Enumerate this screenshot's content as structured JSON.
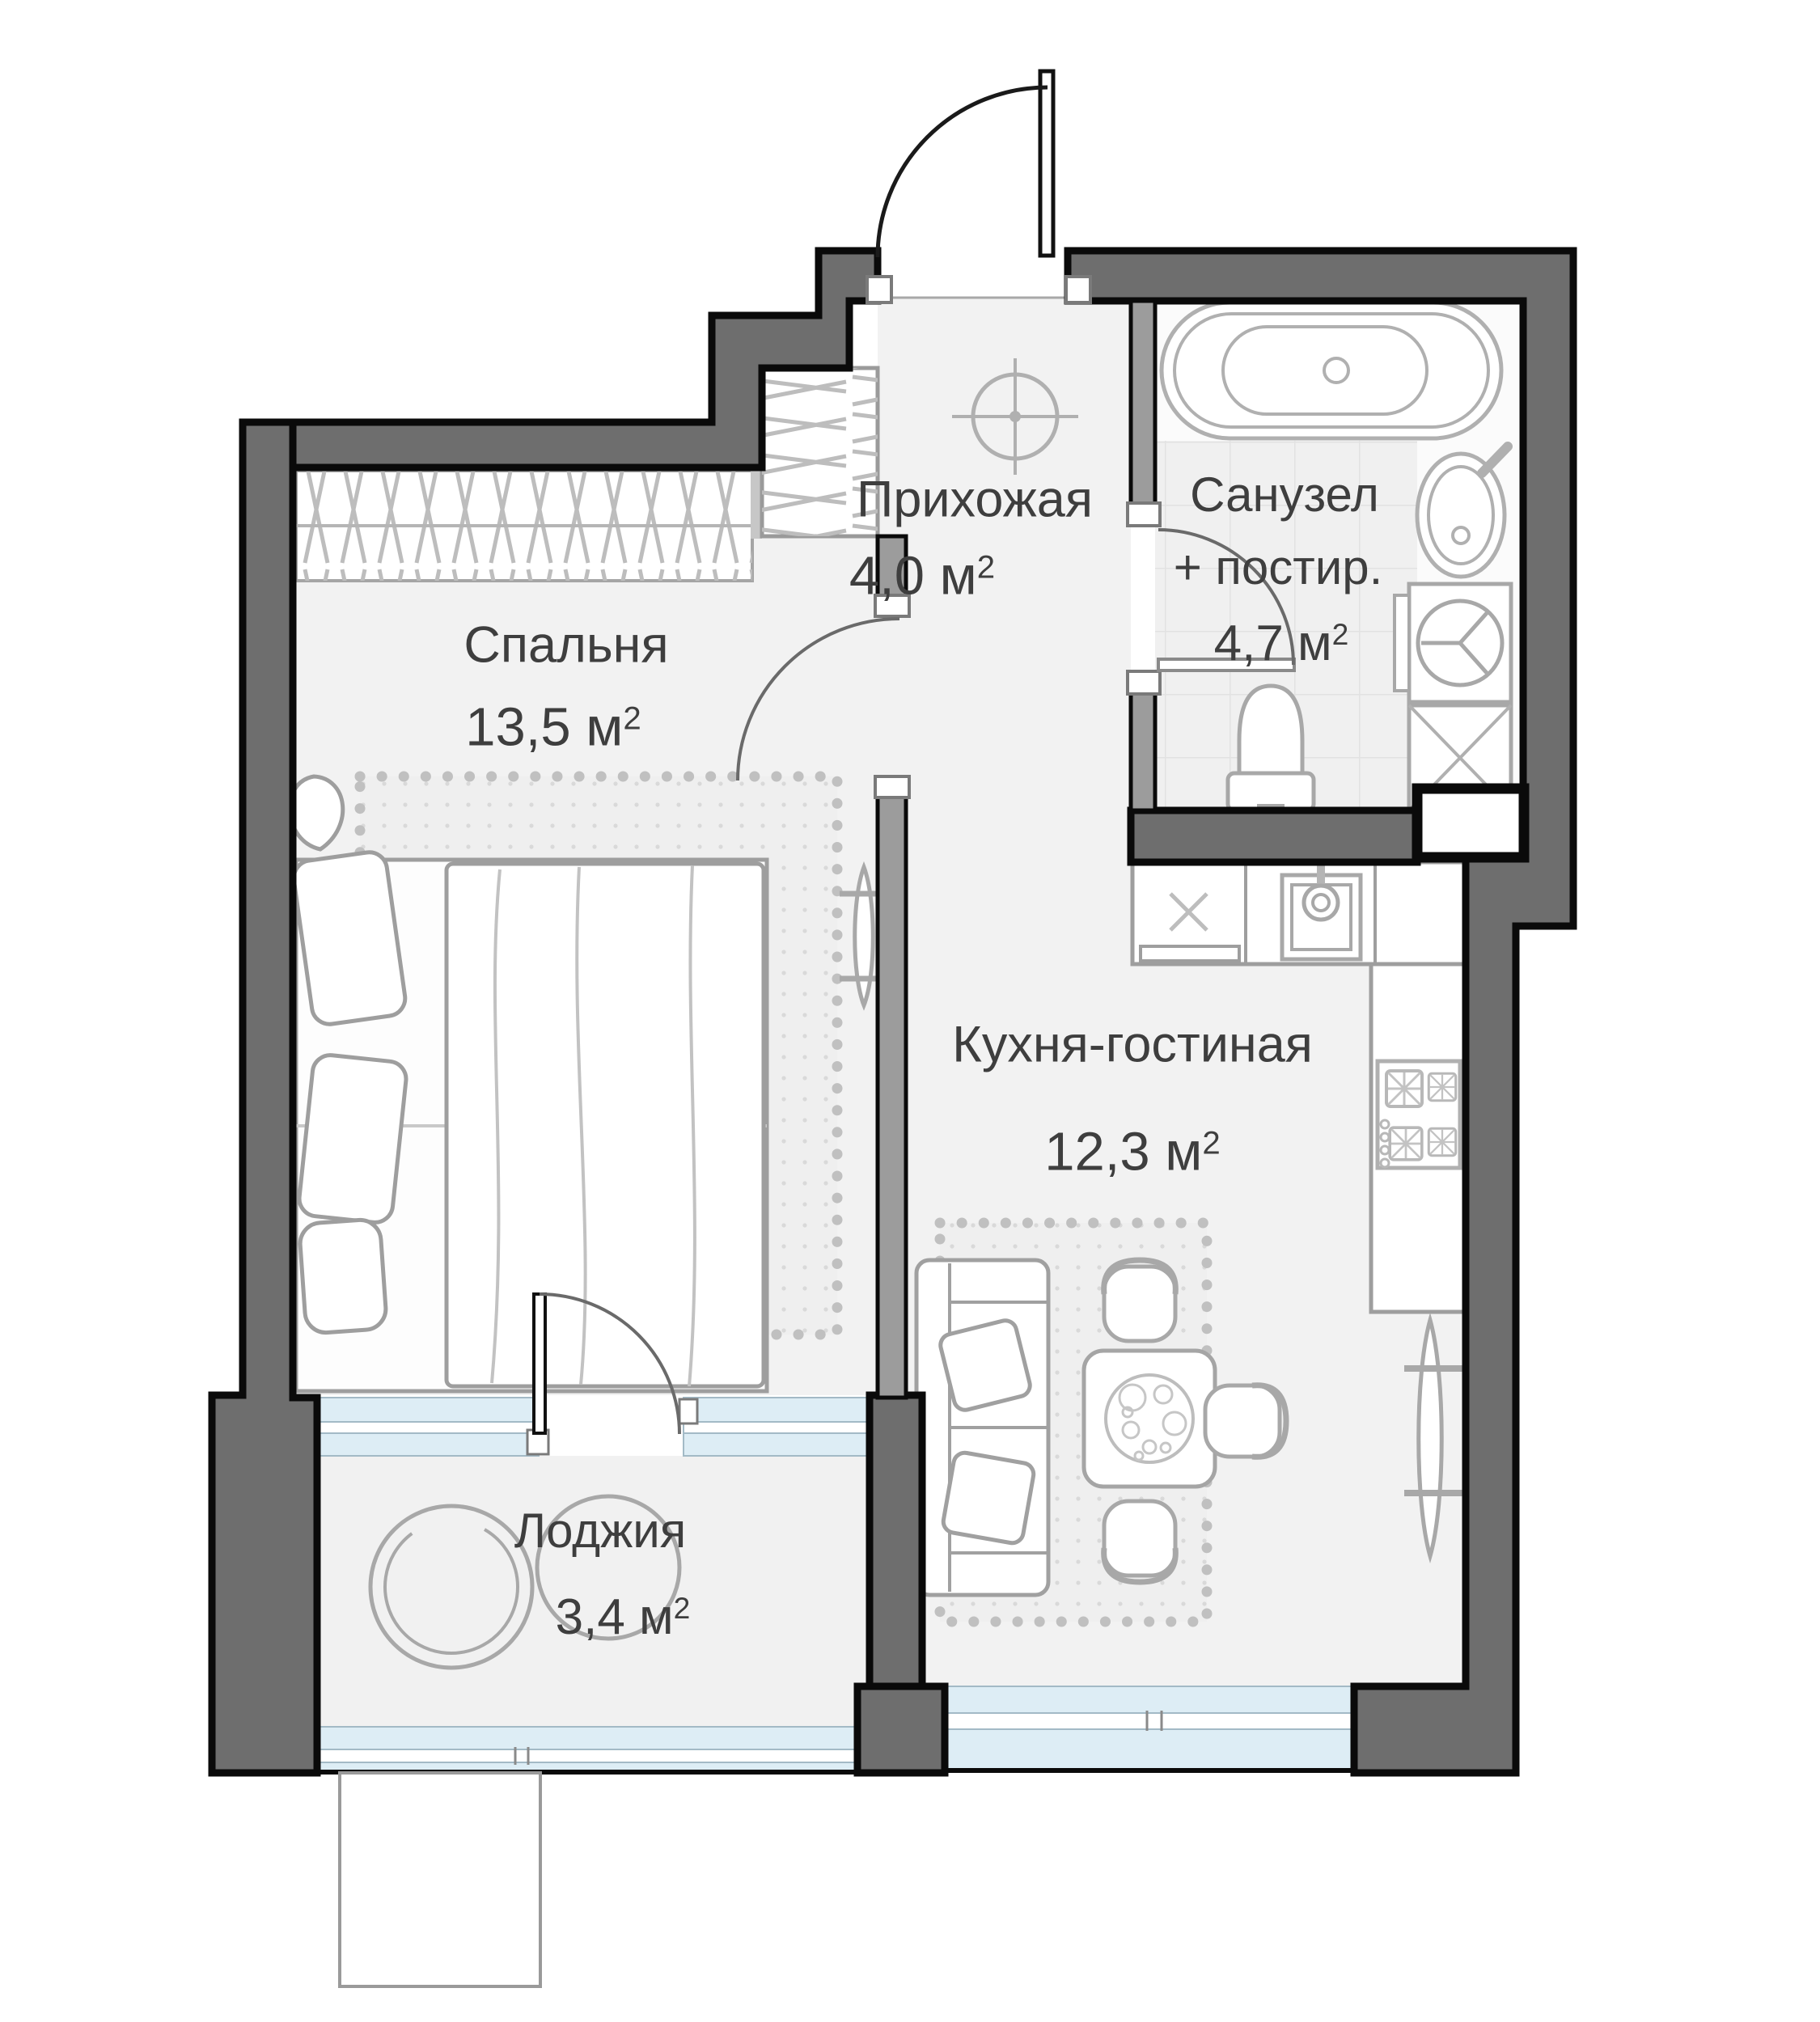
{
  "rooms": [
    {
      "id": "bedroom",
      "name": "Спальня",
      "area": "13,5 м",
      "sup": "2"
    },
    {
      "id": "hallway",
      "name": "Прихожая",
      "area": "4,0 м",
      "sup": "2"
    },
    {
      "id": "bathroom",
      "name": "Санузел",
      "name2": "+ постир.",
      "area": "4,7 м",
      "sup": "2"
    },
    {
      "id": "kitchen",
      "name": "Кухня-гостиная",
      "area": "12,3 м",
      "sup": "2"
    },
    {
      "id": "loggia",
      "name": "Лоджия",
      "area": "3,4 м",
      "sup": "2"
    }
  ],
  "fixtures": [
    "entrance-door",
    "interior-door",
    "bathtub",
    "bathroom-sink",
    "washing-machine",
    "laundry-cabinet",
    "toilet",
    "ceiling-light",
    "kitchen-counter",
    "kitchen-sink",
    "stove",
    "radiator",
    "bed",
    "pillow",
    "pouf",
    "wardrobe",
    "closet",
    "sofa",
    "dining-table",
    "chair",
    "carpet",
    "window-glazing",
    "ventilation-shaft",
    "balcony-platform"
  ],
  "colors": {
    "wall": "#6e6e6e",
    "wall_outline": "#0a0a0a",
    "partition": "#9c9c9c",
    "glazing": "#ddedf5",
    "floor": "#f2f2f2",
    "tile_floor": "#f0f0f0",
    "carpet_dot": "#d9d9d9",
    "furniture_line": "#9e9e9e",
    "label_text": "#3e3e3e"
  }
}
